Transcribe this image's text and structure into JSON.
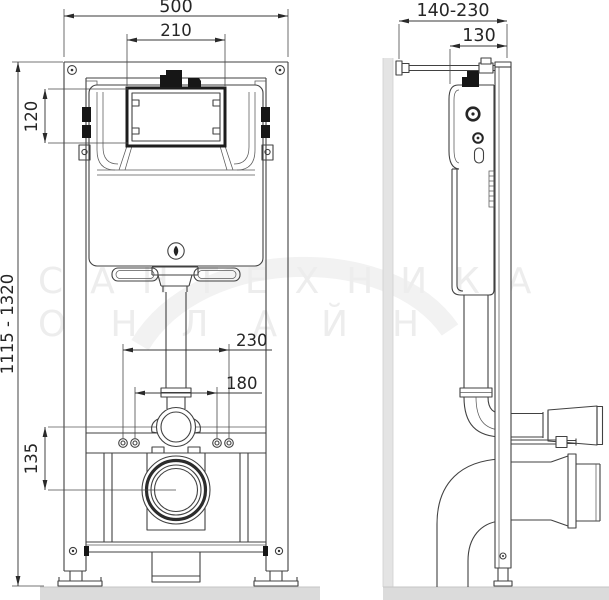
{
  "drawing_title": "wall-hung-wc-installation-frame-dimension-drawing",
  "front_view": {
    "label": "front view",
    "dims": {
      "total_width": "500",
      "access_window_width": "210",
      "access_window_height": "120",
      "frame_height_range": "1115 - 1320",
      "outer_bolt_spacing": "230",
      "inner_bolt_spacing": "180",
      "flushpipe_to_drain": "135"
    }
  },
  "side_view": {
    "label": "side view",
    "dims": {
      "wall_bracket_range": "140-230",
      "frame_depth": "130"
    }
  },
  "watermark": {
    "line1": "САНТЕХНИКА",
    "line2": "ОНЛАЙН"
  },
  "colors": {
    "line": "#414141",
    "dim_text": "#262626",
    "black_fill": "#161616",
    "wall_gray": "#e4e4e4",
    "floor_gray": "#dbdbdb",
    "watermark_gray": "#ededed",
    "background": "#ffffff"
  }
}
